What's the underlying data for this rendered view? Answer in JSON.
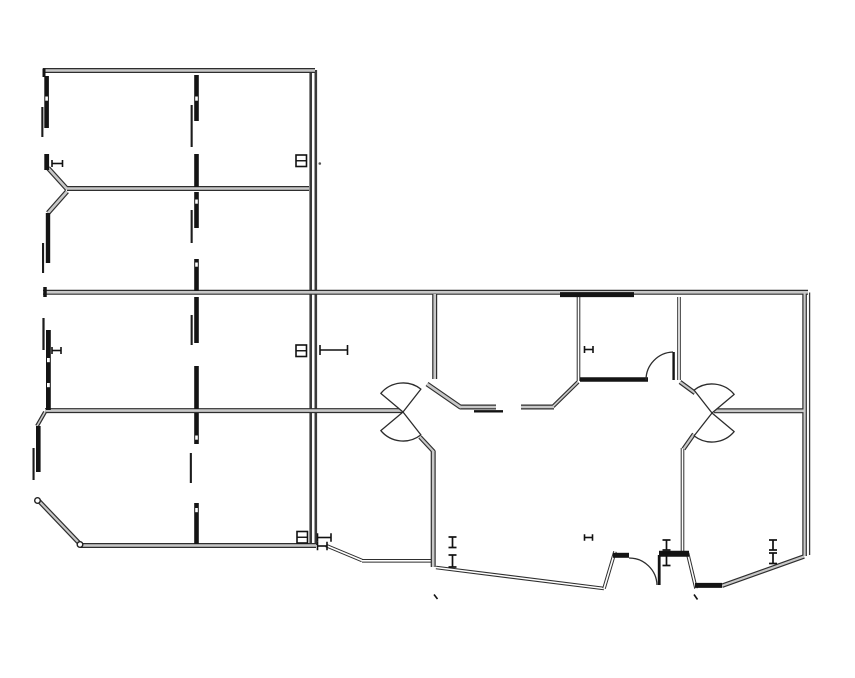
{
  "meta": {
    "drawing_type": "floor-plan",
    "canvas_width": 855,
    "canvas_height": 678,
    "background": "#ffffff"
  },
  "palette": {
    "wall_edge": "#2e2e2e",
    "wall_core": "#c8c8c8",
    "dark_wall": "#141414",
    "double_core": "#ffffff",
    "thin_wall": "#3a3a3a",
    "symbol": "#111111",
    "arc": "#2c2c2c",
    "dot": "#555555"
  },
  "plan": {
    "outline_walls": [
      {
        "x1": 43,
        "y1": 70.5,
        "x2": 315,
        "y2": 70.5,
        "w": 5
      },
      {
        "x1": 67,
        "y1": 188.5,
        "x2": 309,
        "y2": 188.5,
        "w": 5
      },
      {
        "x1": 43,
        "y1": 292.3,
        "x2": 808,
        "y2": 292.3,
        "w": 5
      },
      {
        "x1": 45,
        "y1": 410.6,
        "x2": 402,
        "y2": 410.6,
        "w": 5
      },
      {
        "x1": 80,
        "y1": 545.5,
        "x2": 316,
        "y2": 545.5,
        "w": 5
      },
      {
        "x1": 804.6,
        "y1": 292,
        "x2": 804.6,
        "y2": 556,
        "w": 4.6
      },
      {
        "x1": 434.7,
        "y1": 294,
        "x2": 434.7,
        "y2": 379,
        "w": 5
      },
      {
        "x1": 48,
        "y1": 168,
        "x2": 67,
        "y2": 189,
        "w": 5
      },
      {
        "x1": 67,
        "y1": 191.5,
        "x2": 48,
        "y2": 213,
        "w": 5
      },
      {
        "x1": 45,
        "y1": 412,
        "x2": 37,
        "y2": 426,
        "w": 4
      },
      {
        "x1": 38,
        "y1": 500,
        "x2": 80,
        "y2": 544,
        "w": 4.6
      },
      {
        "x1": 433.2,
        "y1": 451,
        "x2": 433.2,
        "y2": 567,
        "w": 5
      },
      {
        "x1": 427,
        "y1": 384,
        "x2": 461,
        "y2": 407.5,
        "w": 5
      },
      {
        "x1": 460,
        "y1": 407,
        "x2": 496,
        "y2": 407,
        "w": 5
      },
      {
        "x1": 521,
        "y1": 407,
        "x2": 554,
        "y2": 407,
        "w": 5
      },
      {
        "x1": 553,
        "y1": 406.5,
        "x2": 578,
        "y2": 382,
        "w": 4
      },
      {
        "x1": 714,
        "y1": 410.8,
        "x2": 804,
        "y2": 410.8,
        "w": 5
      },
      {
        "x1": 722,
        "y1": 585.8,
        "x2": 804,
        "y2": 556.5,
        "w": 4.5
      },
      {
        "x1": 694,
        "y1": 434,
        "x2": 683.5,
        "y2": 449,
        "w": 4.5
      },
      {
        "x1": 680,
        "y1": 382,
        "x2": 695,
        "y2": 393,
        "w": 4.5
      },
      {
        "x1": 420,
        "y1": 437,
        "x2": 434,
        "y2": 452,
        "w": 4.5
      }
    ],
    "double_walls": [
      {
        "x1": 578.5,
        "y1": 297,
        "x2": 578.5,
        "y2": 381
      },
      {
        "x1": 679,
        "y1": 297,
        "x2": 679,
        "y2": 380
      },
      {
        "x1": 682.5,
        "y1": 448,
        "x2": 682.5,
        "y2": 551
      },
      {
        "x1": 326,
        "y1": 545.5,
        "x2": 362,
        "y2": 560.5
      },
      {
        "x1": 362,
        "y1": 560.8,
        "x2": 431,
        "y2": 560.8
      },
      {
        "x1": 436,
        "y1": 567.5,
        "x2": 604,
        "y2": 588.5
      },
      {
        "x1": 604,
        "y1": 588.5,
        "x2": 615,
        "y2": 551.5
      },
      {
        "x1": 687.5,
        "y1": 553,
        "x2": 696,
        "y2": 588.5
      }
    ],
    "solid_thin_walls": [
      {
        "x1": 310.7,
        "y1": 70,
        "x2": 310.7,
        "y2": 545,
        "w": 2.6
      },
      {
        "x1": 315.8,
        "y1": 70,
        "x2": 315.8,
        "y2": 545,
        "w": 2.6
      },
      {
        "x1": 809.6,
        "y1": 292.5,
        "x2": 809.6,
        "y2": 555,
        "w": 1.3
      }
    ],
    "dark_walls": [
      {
        "x1": 560,
        "y1": 294.6,
        "x2": 634,
        "y2": 294.6,
        "w": 5
      },
      {
        "x1": 580,
        "y1": 379.5,
        "x2": 648,
        "y2": 379.5,
        "w": 4.5
      },
      {
        "x1": 613,
        "y1": 555.3,
        "x2": 629,
        "y2": 555.3,
        "w": 5
      },
      {
        "x1": 659,
        "y1": 553.8,
        "x2": 689,
        "y2": 553.8,
        "w": 6
      },
      {
        "x1": 695,
        "y1": 585.4,
        "x2": 722,
        "y2": 585.4,
        "w": 5
      },
      {
        "x1": 44,
        "y1": 68.5,
        "x2": 44,
        "y2": 77,
        "w": 3
      },
      {
        "x1": 45,
        "y1": 287,
        "x2": 45,
        "y2": 297,
        "w": 3.5
      }
    ],
    "thin_lines": [
      {
        "x1": 474,
        "y1": 411.3,
        "x2": 503,
        "y2": 411.3,
        "w": 2.4
      }
    ],
    "bars": [
      {
        "x": 44.3,
        "y": 76,
        "w": 4.6,
        "h": 52,
        "notches": [
          96.5
        ]
      },
      {
        "x": 44.3,
        "y": 154,
        "w": 4.8,
        "h": 16,
        "notches": []
      },
      {
        "x": 45.8,
        "y": 213,
        "w": 4.4,
        "h": 50,
        "notches": []
      },
      {
        "x": 46,
        "y": 330,
        "w": 4.8,
        "h": 80,
        "notches": [
          358,
          383
        ]
      },
      {
        "x": 36,
        "y": 426,
        "w": 4.6,
        "h": 46,
        "notches": []
      },
      {
        "x": 194.2,
        "y": 75,
        "w": 4.6,
        "h": 46,
        "notches": [
          96.5
        ]
      },
      {
        "x": 194.2,
        "y": 154,
        "w": 4.6,
        "h": 33,
        "notches": []
      },
      {
        "x": 194.2,
        "y": 192,
        "w": 4.6,
        "h": 36,
        "notches": [
          199.5
        ]
      },
      {
        "x": 194.2,
        "y": 259,
        "w": 4.6,
        "h": 32,
        "notches": [
          262.5
        ]
      },
      {
        "x": 194.2,
        "y": 297,
        "w": 4.6,
        "h": 46,
        "notches": []
      },
      {
        "x": 194.2,
        "y": 366,
        "w": 4.6,
        "h": 43,
        "notches": []
      },
      {
        "x": 194.2,
        "y": 413,
        "w": 4.6,
        "h": 31,
        "notches": [
          435.5
        ]
      },
      {
        "x": 194.2,
        "y": 503,
        "w": 4.6,
        "h": 41,
        "notches": [
          508
        ]
      }
    ],
    "thin_bars": [
      {
        "x": 41.3,
        "y": 107,
        "w": 2.1,
        "h": 30
      },
      {
        "x": 42,
        "y": 243,
        "w": 2.1,
        "h": 30
      },
      {
        "x": 42.4,
        "y": 318,
        "w": 2.2,
        "h": 32
      },
      {
        "x": 32.5,
        "y": 448,
        "w": 2.1,
        "h": 32
      },
      {
        "x": 190.6,
        "y": 105,
        "w": 2.1,
        "h": 42
      },
      {
        "x": 190.6,
        "y": 210,
        "w": 2.1,
        "h": 33
      },
      {
        "x": 190.6,
        "y": 315,
        "w": 2.1,
        "h": 30
      },
      {
        "x": 189.8,
        "y": 453,
        "w": 2.1,
        "h": 30
      }
    ],
    "door_fans": [
      {
        "d": "M 403 412 L 380.8 393.4 A 29 29 0 0 1 420.9 389.1 Z"
      },
      {
        "d": "M 403 412 L 380.8 430.6 A 29 29 0 0 0 420.9 434.9 Z"
      },
      {
        "d": "M 712 413 L 734.2 394.4 A 29 29 0 0 0 694.1 390.1 Z"
      },
      {
        "d": "M 712 413 L 734.2 431.6 A 29 29 0 0 1 694.1 435.9 Z"
      }
    ],
    "door_arcs": [
      {
        "d": "M 646 380 A 28 28 0 0 1 673 352"
      },
      {
        "d": "M 629 558 A 28 28 0 0 1 657 585"
      }
    ],
    "door_leaves": [
      {
        "x1": 673.6,
        "y1": 352,
        "x2": 673.6,
        "y2": 380,
        "w": 2.4
      },
      {
        "x1": 659.2,
        "y1": 555,
        "x2": 659.2,
        "y2": 585,
        "w": 2.8
      }
    ],
    "panel_symbols": [
      {
        "x": 296,
        "y": 155,
        "w": 10.5,
        "h": 11.5
      },
      {
        "x": 296,
        "y": 345,
        "w": 10.5,
        "h": 11.5
      },
      {
        "x": 297,
        "y": 531.5,
        "w": 10.5,
        "h": 11.5
      }
    ],
    "beam_symbols": [
      {
        "x1": 320,
        "x2": 347.5,
        "y": 350,
        "t": 10
      },
      {
        "x1": 52,
        "x2": 62.5,
        "y": 163.5,
        "t": 7
      },
      {
        "x1": 52,
        "x2": 61,
        "y": 350.5,
        "t": 7
      },
      {
        "x1": 584.5,
        "x2": 593,
        "y": 349.5,
        "t": 7
      },
      {
        "x1": 584.5,
        "x2": 592.5,
        "y": 537.5,
        "t": 6.5
      },
      {
        "x1": 317.5,
        "x2": 331,
        "y": 537.5,
        "t": 8.5
      },
      {
        "x1": 317.5,
        "x2": 327,
        "y": 546,
        "t": 8.5
      }
    ],
    "column_symbols": [
      {
        "x": 452.5,
        "y1": 537,
        "y2": 547.5,
        "cap": 8
      },
      {
        "x": 452.5,
        "y1": 555,
        "y2": 567,
        "cap": 8
      },
      {
        "x": 666.5,
        "y1": 540,
        "y2": 550,
        "cap": 8
      },
      {
        "x": 666.5,
        "y1": 553,
        "y2": 565.5,
        "cap": 8
      },
      {
        "x": 773,
        "y1": 540,
        "y2": 550,
        "cap": 8
      },
      {
        "x": 773,
        "y1": 553,
        "y2": 563.5,
        "cap": 8
      }
    ],
    "node_circles": [
      {
        "cx": 37.5,
        "cy": 500.5,
        "r": 2.8
      },
      {
        "cx": 80,
        "cy": 544.5,
        "r": 2.8
      }
    ],
    "tick_marks": [
      {
        "x1": 434,
        "y1": 594.5,
        "x2": 437.5,
        "y2": 599
      },
      {
        "x1": 694,
        "y1": 594.5,
        "x2": 697.5,
        "y2": 599.5
      }
    ],
    "dots": [
      {
        "cx": 319.8,
        "cy": 163.5,
        "r": 1.3
      }
    ]
  }
}
